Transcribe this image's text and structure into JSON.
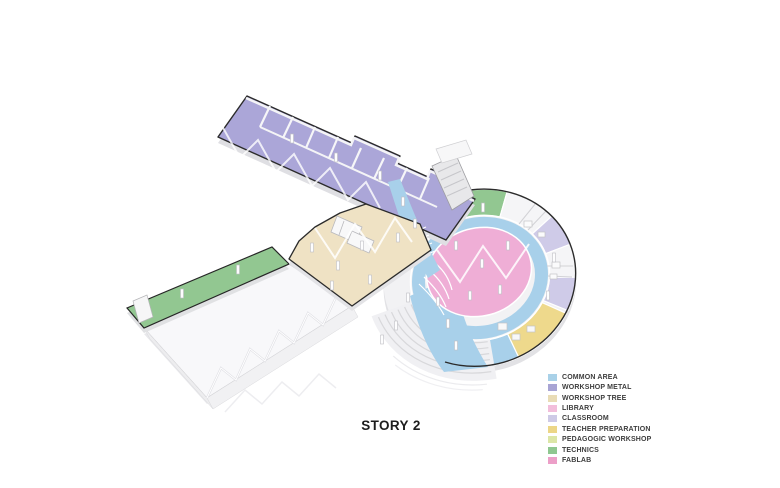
{
  "title": {
    "text": "STORY 2"
  },
  "colors": {
    "common_area": "#a8d0ea",
    "workshop_metal": "#aba6d8",
    "workshop_tree": "#efe2c4",
    "library": "#efaed6",
    "classroom": "#cfcbe8",
    "teacher_preparation": "#eed98c",
    "pedagogic_workshop": "#dce6a7",
    "technics": "#92c791",
    "fablab": "#ec9fc8",
    "outline": "#2b2b2b"
  },
  "legend": {
    "items": [
      {
        "id": "common_area",
        "label": "COMMON AREA",
        "color": "#a9d1e8"
      },
      {
        "id": "workshop_metal",
        "label": "WORKSHOP METAL",
        "color": "#a8a4d4"
      },
      {
        "id": "workshop_tree",
        "label": "WORKSHOP TREE",
        "color": "#e9dcb6"
      },
      {
        "id": "library",
        "label": "LIBRARY",
        "color": "#f2bedb"
      },
      {
        "id": "classroom",
        "label": "CLASSROOM",
        "color": "#cecae6"
      },
      {
        "id": "teacher_preparation",
        "label": "TEACHER PREPARATION",
        "color": "#ecd687"
      },
      {
        "id": "pedagogic_workshop",
        "label": "PEDAGOGIC WORKSHOP",
        "color": "#dce6a7"
      },
      {
        "id": "technics",
        "label": "TECHNICS",
        "color": "#8fc790"
      },
      {
        "id": "fablab",
        "label": "FABLAB",
        "color": "#ec9fc8"
      }
    ]
  }
}
